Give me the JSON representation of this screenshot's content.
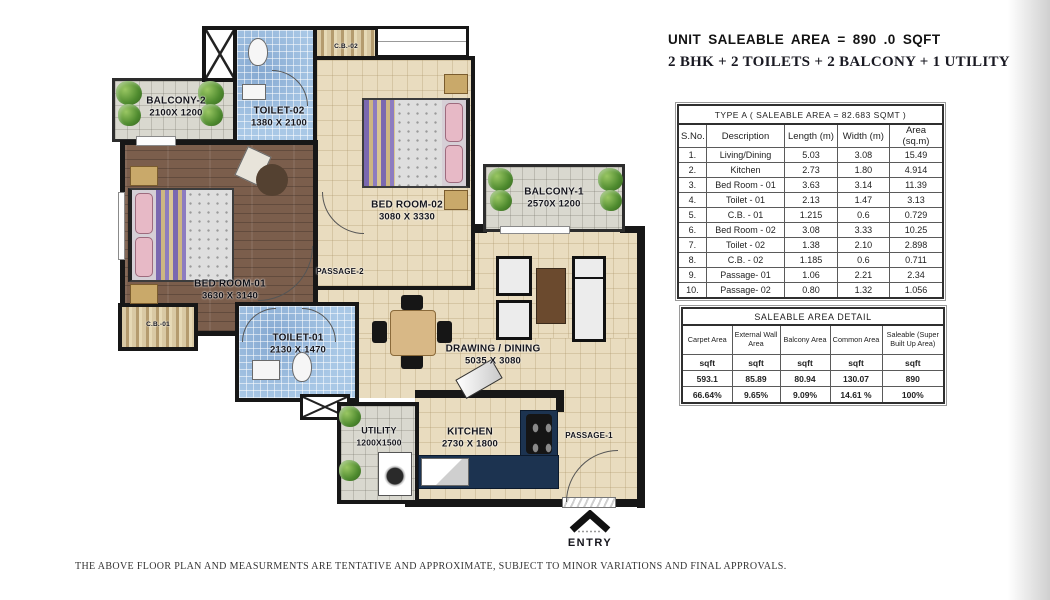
{
  "header": {
    "line1": "UNIT SALEABLE AREA = 890 .0 SQFT",
    "line2": "2 BHK + 2 TOILETS + 2 BALCONY + 1 UTILITY"
  },
  "area_table": {
    "title": "TYPE A  ( SALEABLE AREA = 82.683 SQMT )",
    "columns": [
      "S.No.",
      "Description",
      "Length (m)",
      "Width (m)",
      "Area (sq.m)"
    ],
    "rows": [
      [
        "1.",
        "Living/Dining",
        "5.03",
        "3.08",
        "15.49"
      ],
      [
        "2.",
        "Kitchen",
        "2.73",
        "1.80",
        "4.914"
      ],
      [
        "3.",
        "Bed Room - 01",
        "3.63",
        "3.14",
        "11.39"
      ],
      [
        "4.",
        "Toilet - 01",
        "2.13",
        "1.47",
        "3.13"
      ],
      [
        "5.",
        "C.B. - 01",
        "1.215",
        "0.6",
        "0.729"
      ],
      [
        "6.",
        "Bed Room - 02",
        "3.08",
        "3.33",
        "10.25"
      ],
      [
        "7.",
        "Toilet - 02",
        "1.38",
        "2.10",
        "2.898"
      ],
      [
        "8.",
        "C.B. - 02",
        "1.185",
        "0.6",
        "0.711"
      ],
      [
        "9.",
        "Passage- 01",
        "1.06",
        "2.21",
        "2.34"
      ],
      [
        "10.",
        "Passage- 02",
        "0.80",
        "1.32",
        "1.056"
      ]
    ]
  },
  "saleable_table": {
    "title": "SALEABLE AREA DETAIL",
    "columns": [
      "Carpet Area",
      "External Wall Area",
      "Balcony Area",
      "Common Area",
      "Saleable (Super Built Up Area)"
    ],
    "body": [
      [
        "sqft",
        "sqft",
        "sqft",
        "sqft",
        "sqft"
      ],
      [
        "593.1",
        "85.89",
        "80.94",
        "130.07",
        "890"
      ],
      [
        "66.64%",
        "9.65%",
        "9.09%",
        "14.61 %",
        "100%"
      ]
    ]
  },
  "floorplan": {
    "rooms": {
      "balcony2": {
        "name": "BALCONY-2",
        "dim": "2100X 1200"
      },
      "toilet2": {
        "name": "TOILET-02",
        "dim": "1380 X 2100"
      },
      "cb2": {
        "name": "C.B.-02"
      },
      "bedroom2": {
        "name": "BED ROOM-02",
        "dim": "3080 X 3330"
      },
      "balcony1": {
        "name": "BALCONY-1",
        "dim": "2570X 1200"
      },
      "bedroom1": {
        "name": "BED ROOM-01",
        "dim": "3630 X 3140"
      },
      "passage2": {
        "name": "PASSAGE-2"
      },
      "cb1": {
        "name": "C.B.-01"
      },
      "toilet1": {
        "name": "TOILET-01",
        "dim": "2130 X 1470"
      },
      "drawing": {
        "name": "DRAWING / DINING",
        "dim": "5035 X 3080"
      },
      "utility": {
        "name": "UTILITY",
        "dim": "1200X1500"
      },
      "kitchen": {
        "name": "KITCHEN",
        "dim": "2730 X 1800"
      },
      "passage1": {
        "name": "PASSAGE-1"
      }
    },
    "entry_label": "ENTRY",
    "colors": {
      "wall": "#171717",
      "floor_beige": "#e9dcbf",
      "floor_wood": "#7b5e4c",
      "tile_blue": "#a9c8e6",
      "tile_gray": "#d9d8cf",
      "counter_navy": "#1c3350",
      "plant_green": "#4e8a2e"
    }
  },
  "footer": {
    "disclaimer": "THE ABOVE FLOOR PLAN AND MEASURMENTS ARE TENTATIVE AND APPROXIMATE, SUBJECT TO MINOR VARIATIONS AND FINAL APPROVALS."
  }
}
